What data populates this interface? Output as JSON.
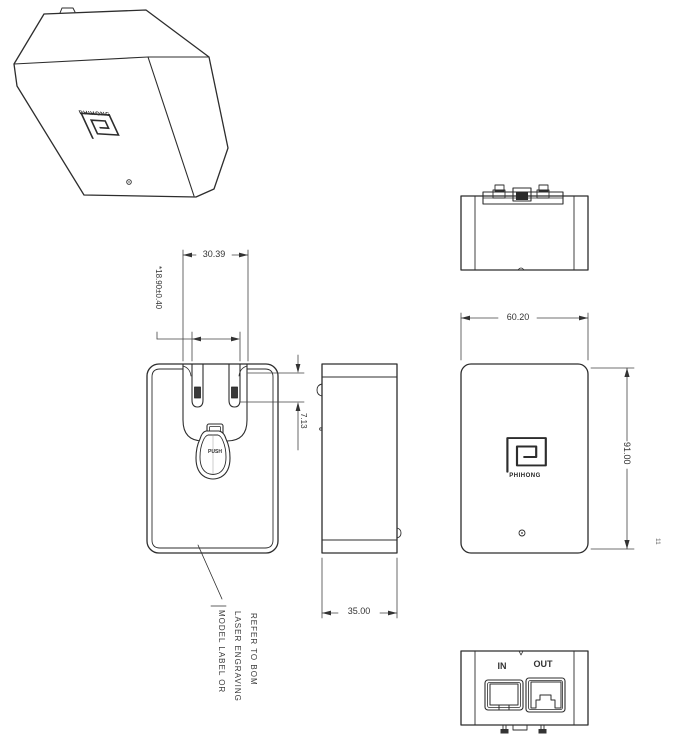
{
  "sheet": {
    "background": "#ffffff",
    "line_color": "#2d2d2d",
    "text_color": "#333333"
  },
  "views": {
    "isometric": {
      "logo_text": "PHIHONG"
    },
    "front": {
      "dim_recess_width": "30.39",
      "dim_blade_span": "*18.90±0.40",
      "dim_blade_offset": "7.13",
      "push_label": "PUSH",
      "note_lines": [
        "MODEL LABEL OR",
        "LASER ENGRAVING",
        "REFER TO BOM"
      ]
    },
    "side": {
      "dim_depth": "35.00"
    },
    "back": {
      "dim_width": "60.20",
      "dim_height": "91.00",
      "logo_text": "PHIHONG",
      "edge_mark": "11"
    },
    "bottom": {
      "port_in_label": "IN",
      "port_out_label": "OUT"
    }
  }
}
